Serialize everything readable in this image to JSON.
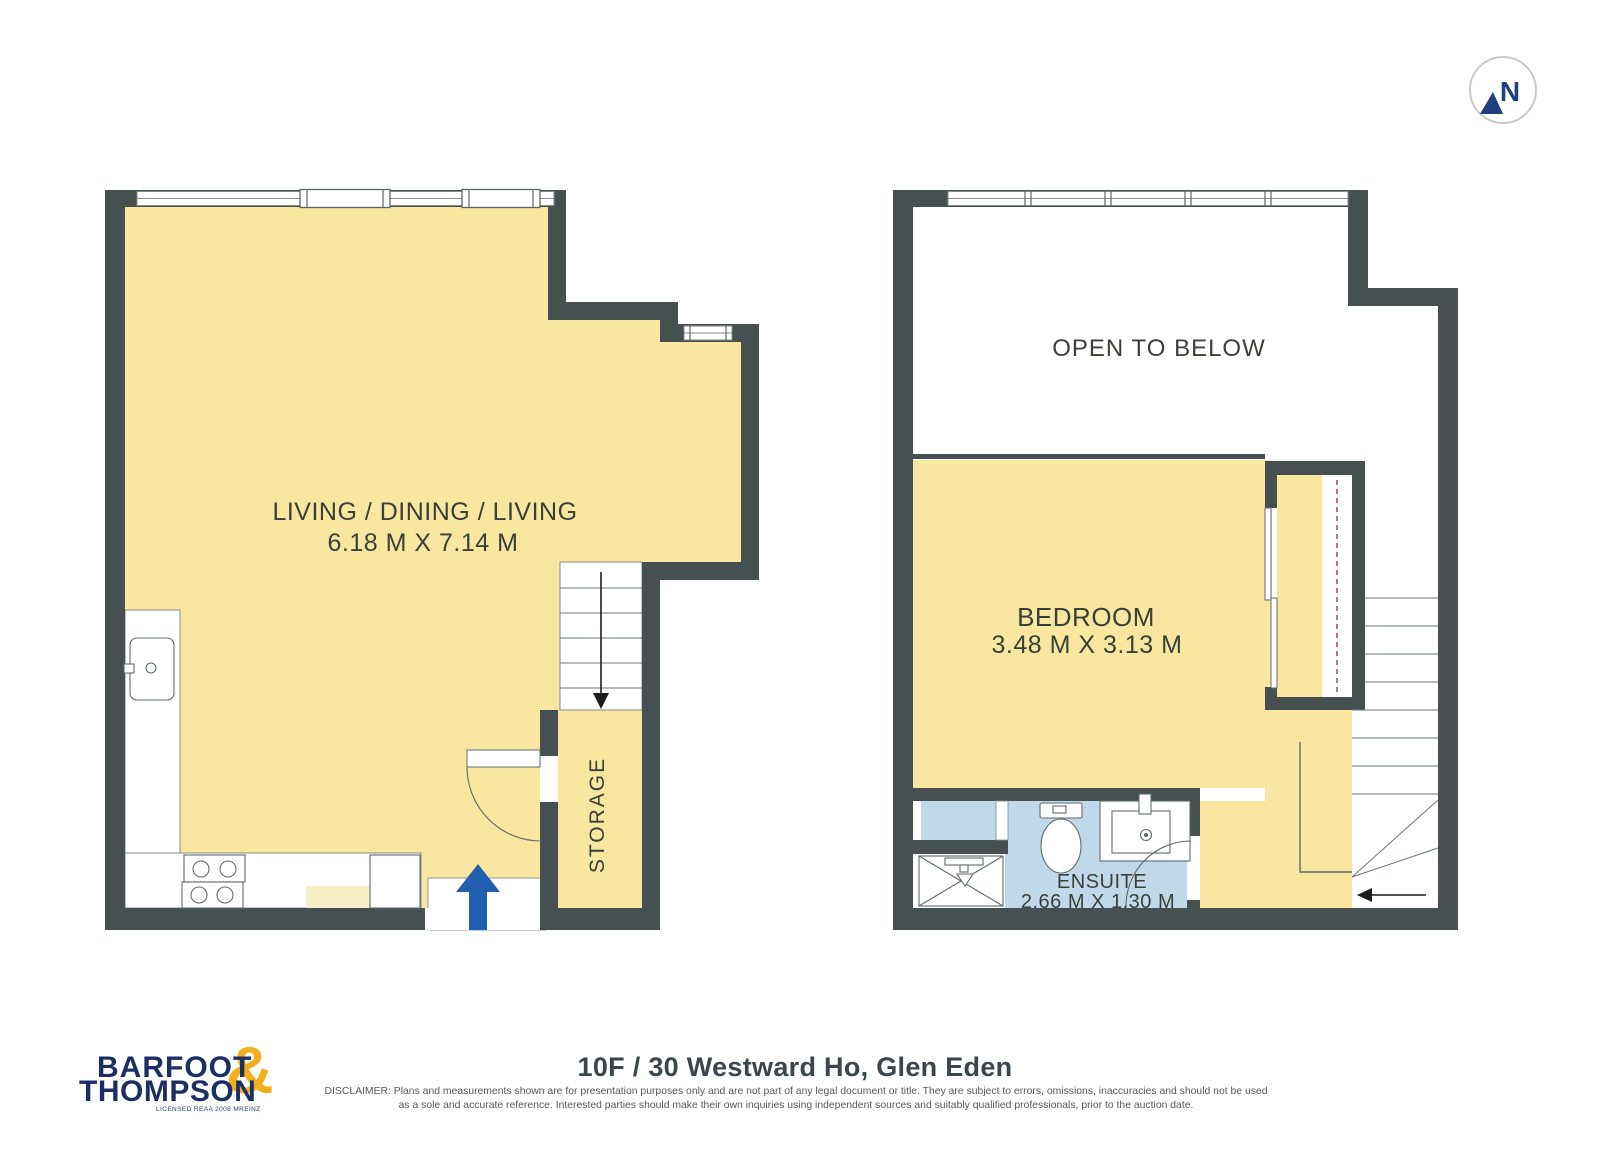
{
  "compass": {
    "label": "N"
  },
  "plans": {
    "level1": {
      "room": {
        "name": "LIVING / DINING / LIVING",
        "dims": "6.18 M X 7.14 M"
      },
      "storage": "STORAGE"
    },
    "level2": {
      "open_to_below": "OPEN TO BELOW",
      "bedroom": {
        "name": "BEDROOM",
        "dims": "3.48 M X 3.13 M"
      },
      "ensuite": {
        "name": "ENSUITE",
        "dims": "2.66 M X 1.30 M"
      }
    }
  },
  "footer": {
    "logo": {
      "line1": "BARFOOT",
      "line2": "THOMPSON",
      "amp": "&",
      "tagline": "LICENSED REAA 2008 MREINZ"
    },
    "title": "10F / 30 Westward Ho, Glen Eden",
    "disclaimer_line1": "DISCLAIMER: Plans and measurements shown are for presentation purposes only and are not part of any legal document or title. They are subject to errors, omissions, inaccuracies and should not be used",
    "disclaimer_line2": "as a sole and accurate reference. Interested parties should make their own inquiries using independent sources and suitably qualified professionals, prior to the auction date."
  },
  "icons": {
    "entry_arrow": "arrow-up",
    "level1_stair_arrow": "arrow-down",
    "level2_stair_arrow": "arrow-left",
    "compass_arrow": "north-arrow"
  },
  "colors": {
    "wall": "#475051",
    "floor_yellow": "#f9e7a1",
    "floor_pale": "#f8efc8",
    "ensuite_blue": "#bfd9eb",
    "arrow_blue": "#2160ae",
    "compass_navy": "#1f3f7f",
    "logo_navy": "#1c2f62",
    "logo_gold": "#f2b01e"
  }
}
